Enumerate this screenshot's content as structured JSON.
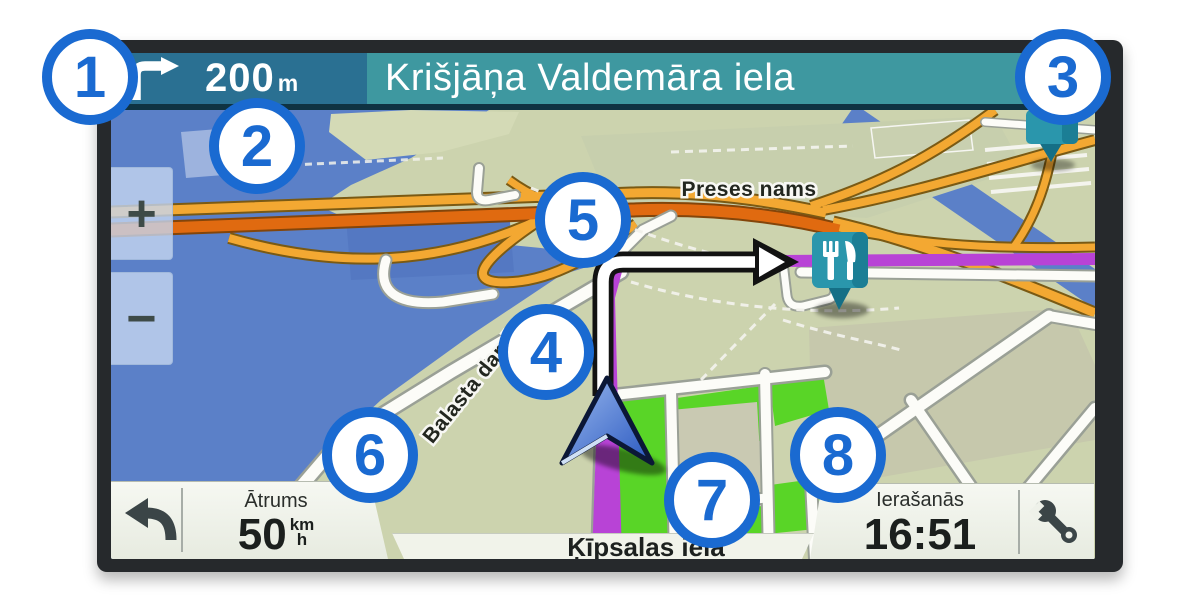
{
  "nav_bar": {
    "turn_icon": "right-turn-arrow",
    "distance": "200",
    "distance_unit": "m",
    "next_street": "Krišjāņa Valdemāra iela"
  },
  "map": {
    "zoom_in": "+",
    "zoom_out": "−",
    "labels": {
      "building": "Preses nams",
      "street": "Balasta dambis"
    },
    "poi": {
      "type": "restaurant-pin"
    },
    "colors": {
      "water": "#5b80c8",
      "land": "#ccd3ae",
      "park": "#59d527",
      "highway": "#f3a832",
      "highway_dark": "#e06a10",
      "route": "#b843d6"
    }
  },
  "status_bar": {
    "back_icon": "back-arrow",
    "speed_label": "Ātrums",
    "speed_value": "50",
    "speed_unit_top": "km",
    "speed_unit_bottom": "h",
    "current_street": "Ķīpsalas iela",
    "arrival_label": "Ierašanās",
    "arrival_time": "16:51",
    "tools_icon": "wrench"
  },
  "callouts": [
    "1",
    "2",
    "3",
    "4",
    "5",
    "6",
    "7",
    "8"
  ],
  "colors": {
    "callout_blue": "#1a6ad1",
    "topbar_left": "#2a7092",
    "topbar_right": "#3e98a0",
    "bezel": "#26292c"
  }
}
